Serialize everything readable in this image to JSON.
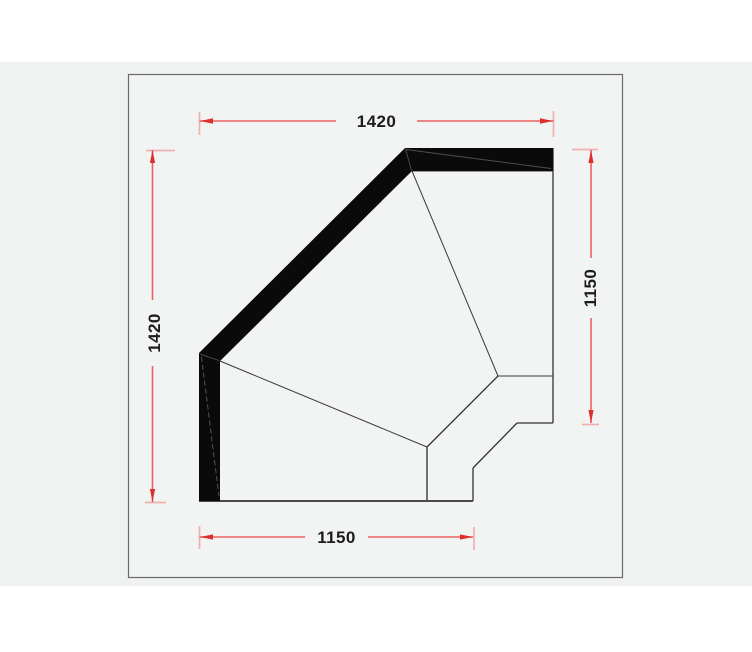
{
  "dimensions": {
    "top": {
      "value": "1420"
    },
    "left": {
      "value": "1420"
    },
    "right": {
      "value": "1150"
    },
    "bottom": {
      "value": "1150"
    }
  },
  "colors": {
    "dimension_line": "#e96161",
    "dimension_tick": "#f0b0b0",
    "dimension_arrow": "#de2f2f",
    "label_text": "#1c1c1c",
    "drawing_ink": "#0a0a0a",
    "outline": "#3b3b3b",
    "panel_border": "#6b6b6b",
    "panel_fill": "#f2f3f3",
    "canvas_gray": "#f0f1f1",
    "page_background": "#ffffff"
  }
}
